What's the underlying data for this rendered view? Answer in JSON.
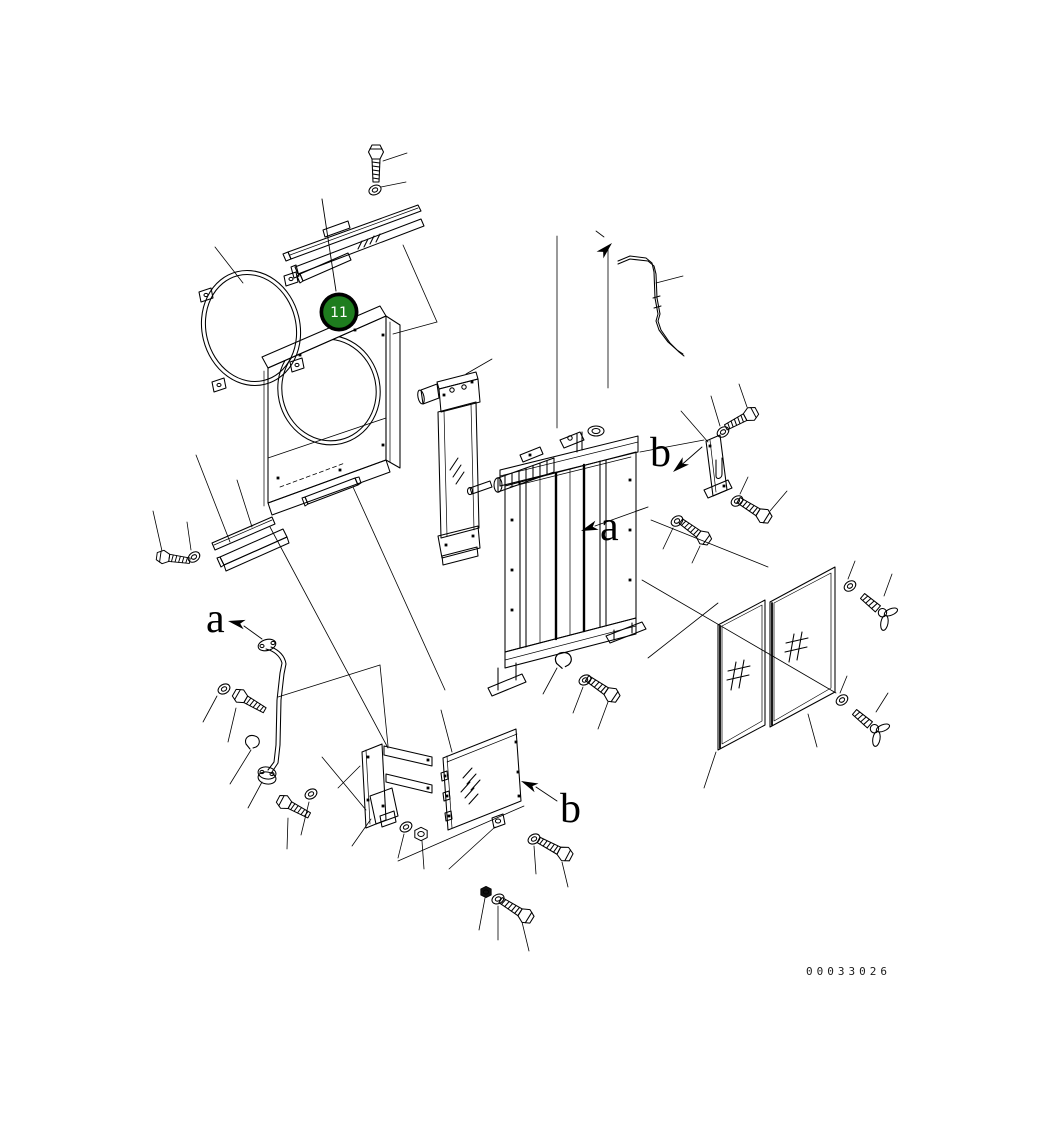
{
  "figure": {
    "drawing_number": "00033026"
  },
  "callout": {
    "label": "11",
    "fill": "#1e7d1e",
    "ring_color": "#000000",
    "text_color": "#ffffff"
  },
  "view_labels": {
    "a_left": "a",
    "a_center": "a",
    "b_right": "b",
    "b_bottom": "b"
  },
  "colors": {
    "background": "#ffffff",
    "line": "#000000"
  },
  "components": [
    {
      "name": "mounting-bolt-top"
    },
    {
      "name": "washer-top"
    },
    {
      "name": "seal-strip-assembly-top"
    },
    {
      "name": "fan-guard-ring"
    },
    {
      "name": "fan-shroud"
    },
    {
      "name": "shroud-bottom-seal-strip"
    },
    {
      "name": "lower-seal-strips"
    },
    {
      "name": "stay-pipe"
    },
    {
      "name": "hose-clamp"
    },
    {
      "name": "oil-cooler"
    },
    {
      "name": "radiator-assembly"
    },
    {
      "name": "overflow-tube"
    },
    {
      "name": "mounting-bracket-right"
    },
    {
      "name": "mesh-screen-left"
    },
    {
      "name": "mesh-screen-right"
    },
    {
      "name": "wing-bolt-upper"
    },
    {
      "name": "wing-bolt-lower"
    },
    {
      "name": "lower-bracket"
    },
    {
      "name": "lower-cover-plate"
    },
    {
      "name": "assorted-bolts-washers-nuts"
    }
  ]
}
